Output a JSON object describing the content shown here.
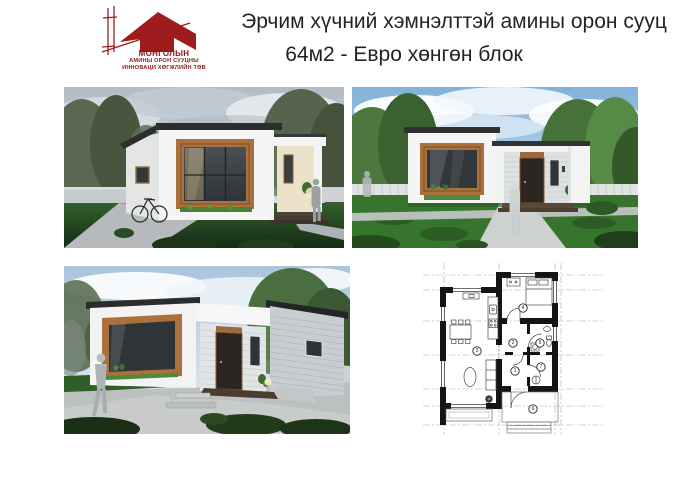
{
  "page": {
    "background": "#ffffff"
  },
  "logo": {
    "line1": "МОНГОЛЫН",
    "line2": "АМИНЫ ОРОН СУУЦНЫ",
    "line3": "ИННОВАЦИ ХӨГЖЛИЙН ТӨВ",
    "accent_color": "#9e1c1c"
  },
  "title": {
    "line1": "Эрчим хүчний хэмнэлттэй амины орон сууц",
    "line2": "64м2 - Евро хөнгөн  блок"
  },
  "gallery": {
    "items": [
      {
        "name": "render-angled-view-overcast"
      },
      {
        "name": "render-front-view"
      },
      {
        "name": "render-entrance-view"
      },
      {
        "name": "floor-plan"
      }
    ]
  },
  "floor_plan": {
    "room_numbers": [
      "1",
      "2",
      "3",
      "4",
      "5",
      "6",
      "7"
    ]
  }
}
